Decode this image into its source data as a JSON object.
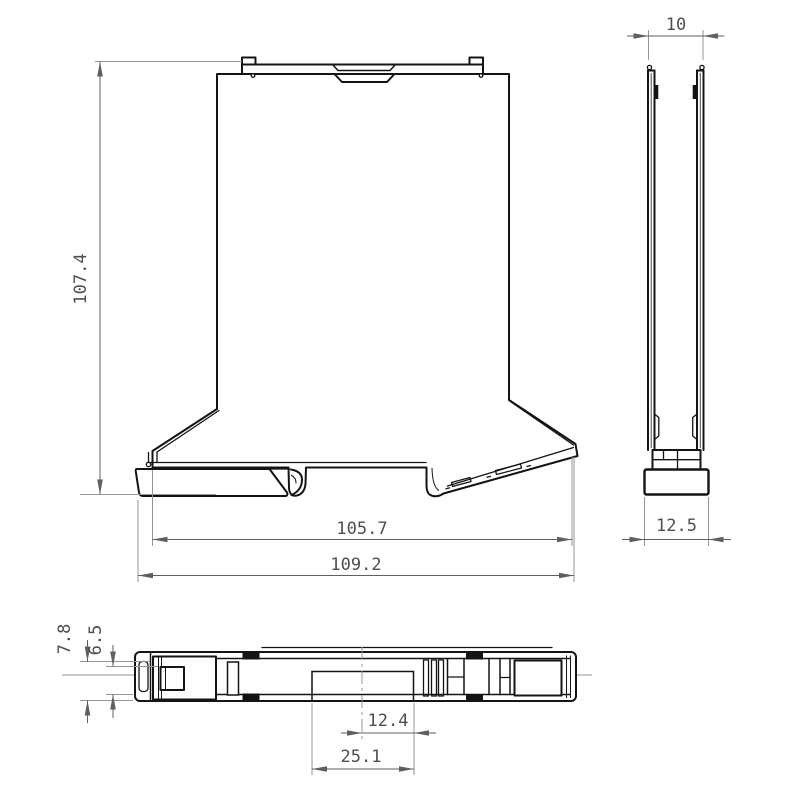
{
  "views": {
    "front": {
      "height": "107.4",
      "body_width": "105.7",
      "overall_width": "109.2"
    },
    "side": {
      "top_width": "10",
      "foot_width": "12.5"
    },
    "bottom": {
      "outer_depth": "7.8",
      "inner_depth": "6.5",
      "cutout_offset": "12.4",
      "cutout_width": "25.1"
    }
  },
  "style": {
    "background": "#ffffff",
    "outline": "#141414",
    "dim_line": "#5f5f5f",
    "extension_line": "#949494",
    "label": "#4f4f4f"
  }
}
